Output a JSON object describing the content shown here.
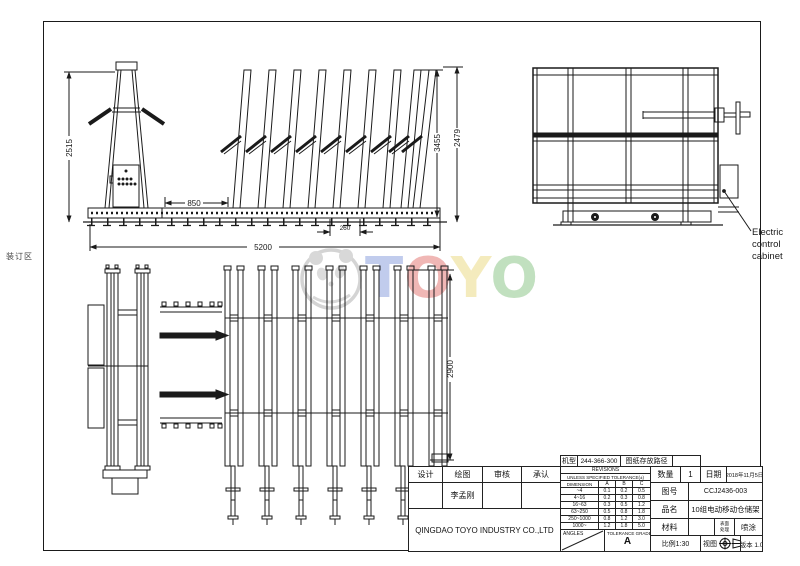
{
  "sheet": {
    "binding_area_label": "装订区"
  },
  "watermark": {
    "letters": [
      "T",
      "O",
      "Y",
      "O"
    ],
    "letter_colors": [
      "#b2bfe9",
      "#eda5a2",
      "#f2e6ad",
      "#b2d8af"
    ],
    "panda_color": "#cccccc"
  },
  "views": {
    "front": {
      "dim_height_left": "2515",
      "dim_gap": "850",
      "dim_pitch": "260",
      "dim_total_width": "5200",
      "dim_height_inner": "3455",
      "dim_height_outer": "2479"
    },
    "side": {
      "callout_lines": [
        "Electric",
        "control",
        "cabinet"
      ]
    },
    "plan": {
      "dim_depth": "2900"
    }
  },
  "title_block": {
    "top_strip": {
      "machine_label": "机型",
      "machine_value": "244-366-300",
      "path_label": "图纸存放路径",
      "path_value": ""
    },
    "personnel": {
      "design_label": "设计",
      "draw_label": "绘图",
      "check_label": "审核",
      "approve_label": "承认",
      "design_value": "",
      "draw_value": "李孟刚",
      "check_value": "",
      "approve_value": ""
    },
    "company": "QINGDAO TOYO INDUSTRY CO.,LTD",
    "tolerance": {
      "revisions_label": "REVISIONS",
      "header": "UNLESS SPECIFIED TOLERANCE(±)",
      "columns": [
        "DIMENSION",
        "A",
        "B",
        "C"
      ],
      "rows": [
        [
          "~4",
          "0.1",
          "0.2",
          "0.5"
        ],
        [
          "4~16",
          "0.2",
          "0.3",
          "0.8"
        ],
        [
          "16~63",
          "0.3",
          "0.5",
          "1.2"
        ],
        [
          "63~250",
          "0.5",
          "0.8",
          "1.8"
        ],
        [
          "250~1000",
          "0.8",
          "1.2",
          "3.0"
        ],
        [
          "1000~",
          "1.2",
          "1.8",
          "5.0"
        ]
      ],
      "angles_label": "ANGLES",
      "grade_label": "TOLERANCE GRADE",
      "grade_value": "A"
    },
    "info": {
      "qty_label": "数量",
      "qty_value": "1",
      "date_label": "日期",
      "date_value": "2018年11月5日",
      "dwg_label": "图号",
      "dwg_value": "CCJ2436-003",
      "name_label": "品名",
      "name_value": "10组电动移动仓储架",
      "material_label": "材料",
      "material_value": "",
      "surface_label_line1": "表面",
      "surface_label_line2": "处理",
      "surface_value": "喷涂",
      "scale_text": "比例1:30",
      "view_label": "视图",
      "version_text": "版本 1.0"
    }
  }
}
